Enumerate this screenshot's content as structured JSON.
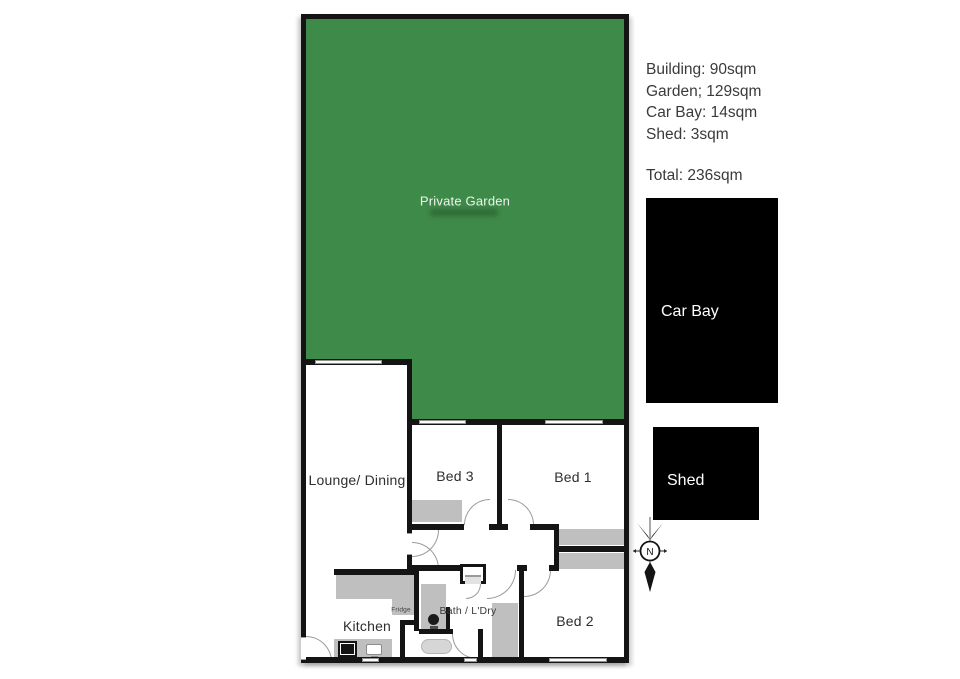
{
  "colors": {
    "garden_fill": "#3e8a49",
    "garden_text": "#edf3ed",
    "wall": "#141414",
    "furniture": "#bfbfbf",
    "outbuilding_fill": "#000000",
    "outbuilding_text": "#ffffff",
    "panel_text": "#3a3a3a"
  },
  "panel": {
    "lines": [
      "Building: 90sqm",
      "Garden; 129sqm",
      "Car Bay: 14sqm",
      "Shed: 3sqm"
    ],
    "total": "Total: 236sqm"
  },
  "plan": {
    "garden_label": "Private Garden",
    "lounge_label": "Lounge/ Dining",
    "bed3_label": "Bed 3",
    "bed1_label": "Bed 1",
    "bed2_label": "Bed 2",
    "kitchen_label": "Kitchen",
    "fridge_label": "Fridge",
    "bath_label": "Bath / L'Dry"
  },
  "outbuildings": {
    "car_bay_label": "Car Bay",
    "shed_label": "Shed"
  },
  "compass": {
    "label": "N"
  }
}
